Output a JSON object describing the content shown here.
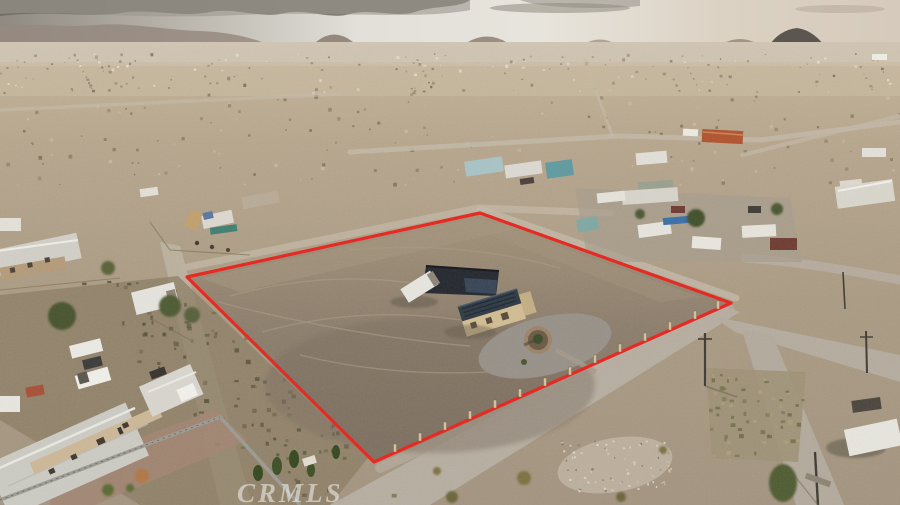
{
  "image": {
    "kind": "aerial-drone-photograph",
    "subject": "rural desert land listing with red-outlined parcel, house with solar roof, surrounding mobile homes and dirt roads"
  },
  "watermark": {
    "text": "CRMLS"
  },
  "boundary": {
    "color": "#e8231d",
    "points": "187,277 480,213 731,303 374,462",
    "stroke_width": "3.2"
  },
  "palette": {
    "sky_cloud_dark": "#6d6a62",
    "sky_bright": "#e7e4dc",
    "sky_right_tan": "#d5cabb",
    "mountain": "#8d7f73",
    "butte_dark": "#5b5750",
    "desert_upper": "#bcab92",
    "desert_mid": "#ab9b84",
    "parcel_pad": "#8d7e6c",
    "road": "#bcb3a6",
    "gravel": "#98928a",
    "scrub_dark": "#55503a",
    "house_roof_solar": "#2e3944",
    "house_wall_tan": "#d2bd92",
    "trailer_white": "#e7e5de",
    "red_tile_roof": "#b1532f"
  }
}
